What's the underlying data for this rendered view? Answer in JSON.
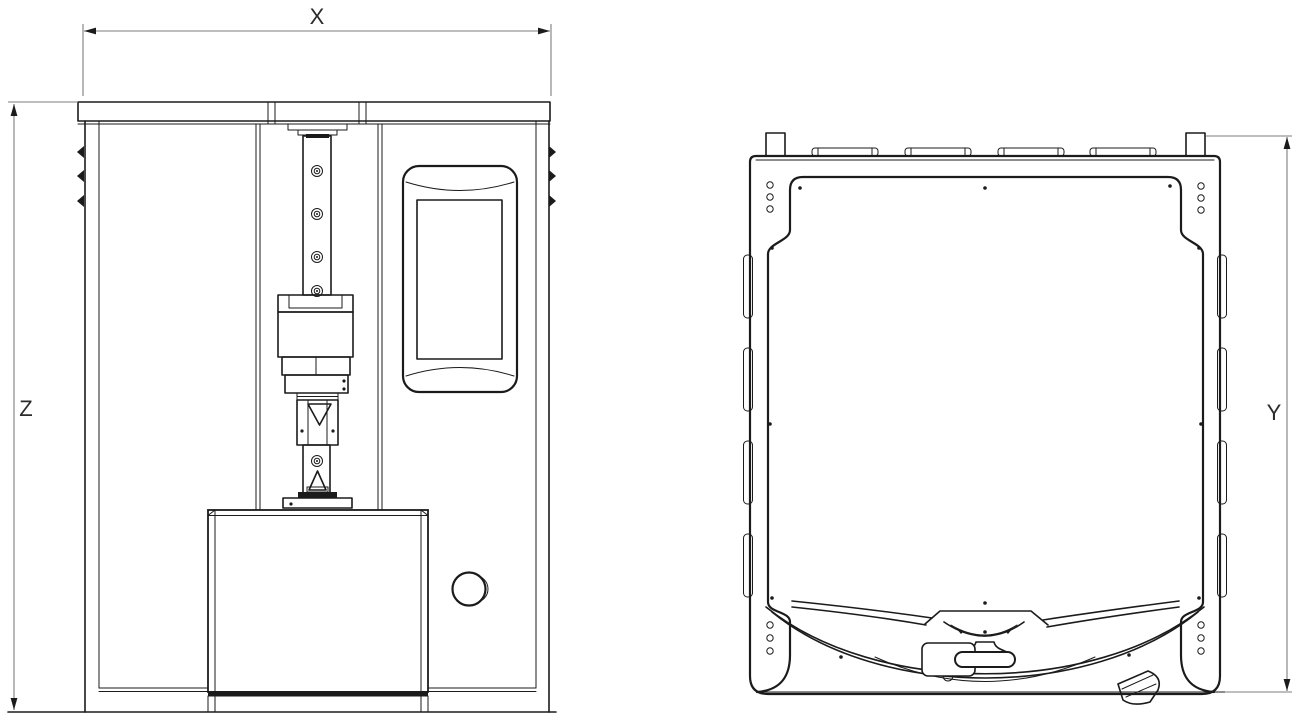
{
  "drawing": {
    "dimension_labels": {
      "x": "X",
      "y": "Y",
      "z": "Z"
    },
    "colors": {
      "line": "#1b1b1b",
      "dimension_line": "#7d7d7d",
      "label": "#2b2b2b",
      "background": "#ffffff"
    }
  }
}
